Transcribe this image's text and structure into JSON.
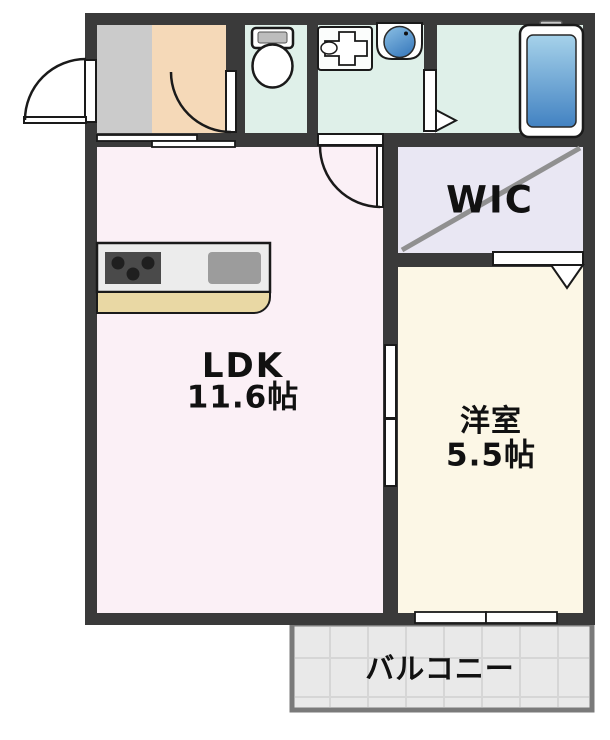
{
  "floorplan": {
    "rooms": {
      "ldk": {
        "label": "LDK",
        "size": "11.6帖"
      },
      "western_room": {
        "label": "洋室",
        "size": "5.5帖"
      },
      "wic": {
        "label": "WIC"
      },
      "balcony": {
        "label": "バルコニー"
      }
    },
    "fixture_icons": [
      "entrance-door-icon",
      "toilet-icon",
      "washing-machine-pan-icon",
      "washbasin-icon",
      "bathtub-icon",
      "stove-icon",
      "kitchen-sink-icon",
      "kitchen-counter"
    ],
    "colors": {
      "wall": "#3a3a3a",
      "outline": "#1a1a1a",
      "genkan": "#cbcbcb",
      "hallway": "#f5d9b8",
      "wetroom": "#dff0e9",
      "ldk": "#fbf0f6",
      "wic": "#e9e7f3",
      "western": "#fcf7e6",
      "balcony": "#e9e9e9",
      "balcony_grid": "#d6d6d6",
      "balcony_border": "#7a7a7a",
      "counter": "#ececec",
      "counter_ledge": "#e9d8a4",
      "stove": "#4a4a4a",
      "burner": "#1f1f1f",
      "sink": "#9c9c9c",
      "tub_blue_light": "#a6d2ea",
      "tub_blue_dark": "#4282c2",
      "wic_diagonal": "#909090"
    }
  }
}
